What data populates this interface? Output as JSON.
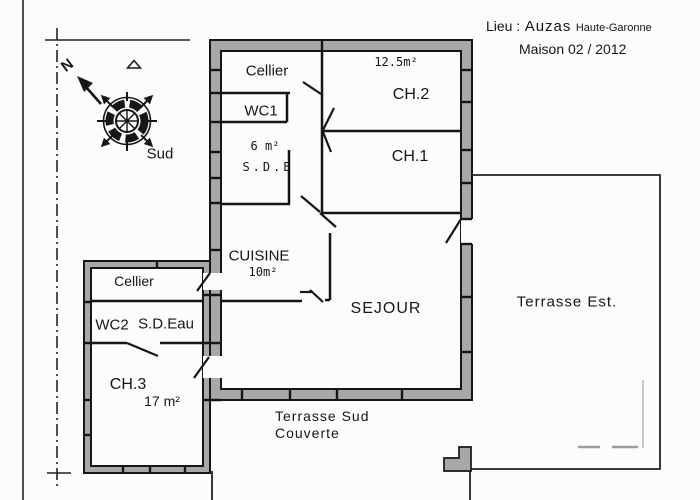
{
  "header": {
    "lieu_label": "Lieu :",
    "place": "Auzas",
    "region": "Haute-Garonne",
    "line2": "Maison  02 / 2012"
  },
  "compass": {
    "north": "N",
    "south": "Sud"
  },
  "rooms": {
    "cellier_main": {
      "label": "Cellier"
    },
    "wc1": {
      "label": "WC1"
    },
    "sdb": {
      "area": "6 m²",
      "label": "S.D.B"
    },
    "ch2": {
      "area": "12.5m²",
      "label": "CH.2"
    },
    "ch1": {
      "label": "CH.1"
    },
    "cuisine": {
      "label": "CUISINE",
      "area": "10m²"
    },
    "sejour": {
      "label": "SEJOUR"
    },
    "cellier_annex": {
      "label": "Cellier"
    },
    "wc2": {
      "label": "WC2"
    },
    "sdeau": {
      "label": "S.D.Eau"
    },
    "ch3": {
      "label": "CH.3",
      "area": "17 m²"
    }
  },
  "outdoor": {
    "terrasse_est": {
      "label": "Terrasse  Est."
    },
    "terrasse_sud": {
      "line1": "Terrasse  Sud",
      "line2": "Couverte"
    }
  },
  "colors": {
    "wall_fill": "#a8a8a8",
    "line": "#161616",
    "ghost": "#c8c8c8"
  }
}
